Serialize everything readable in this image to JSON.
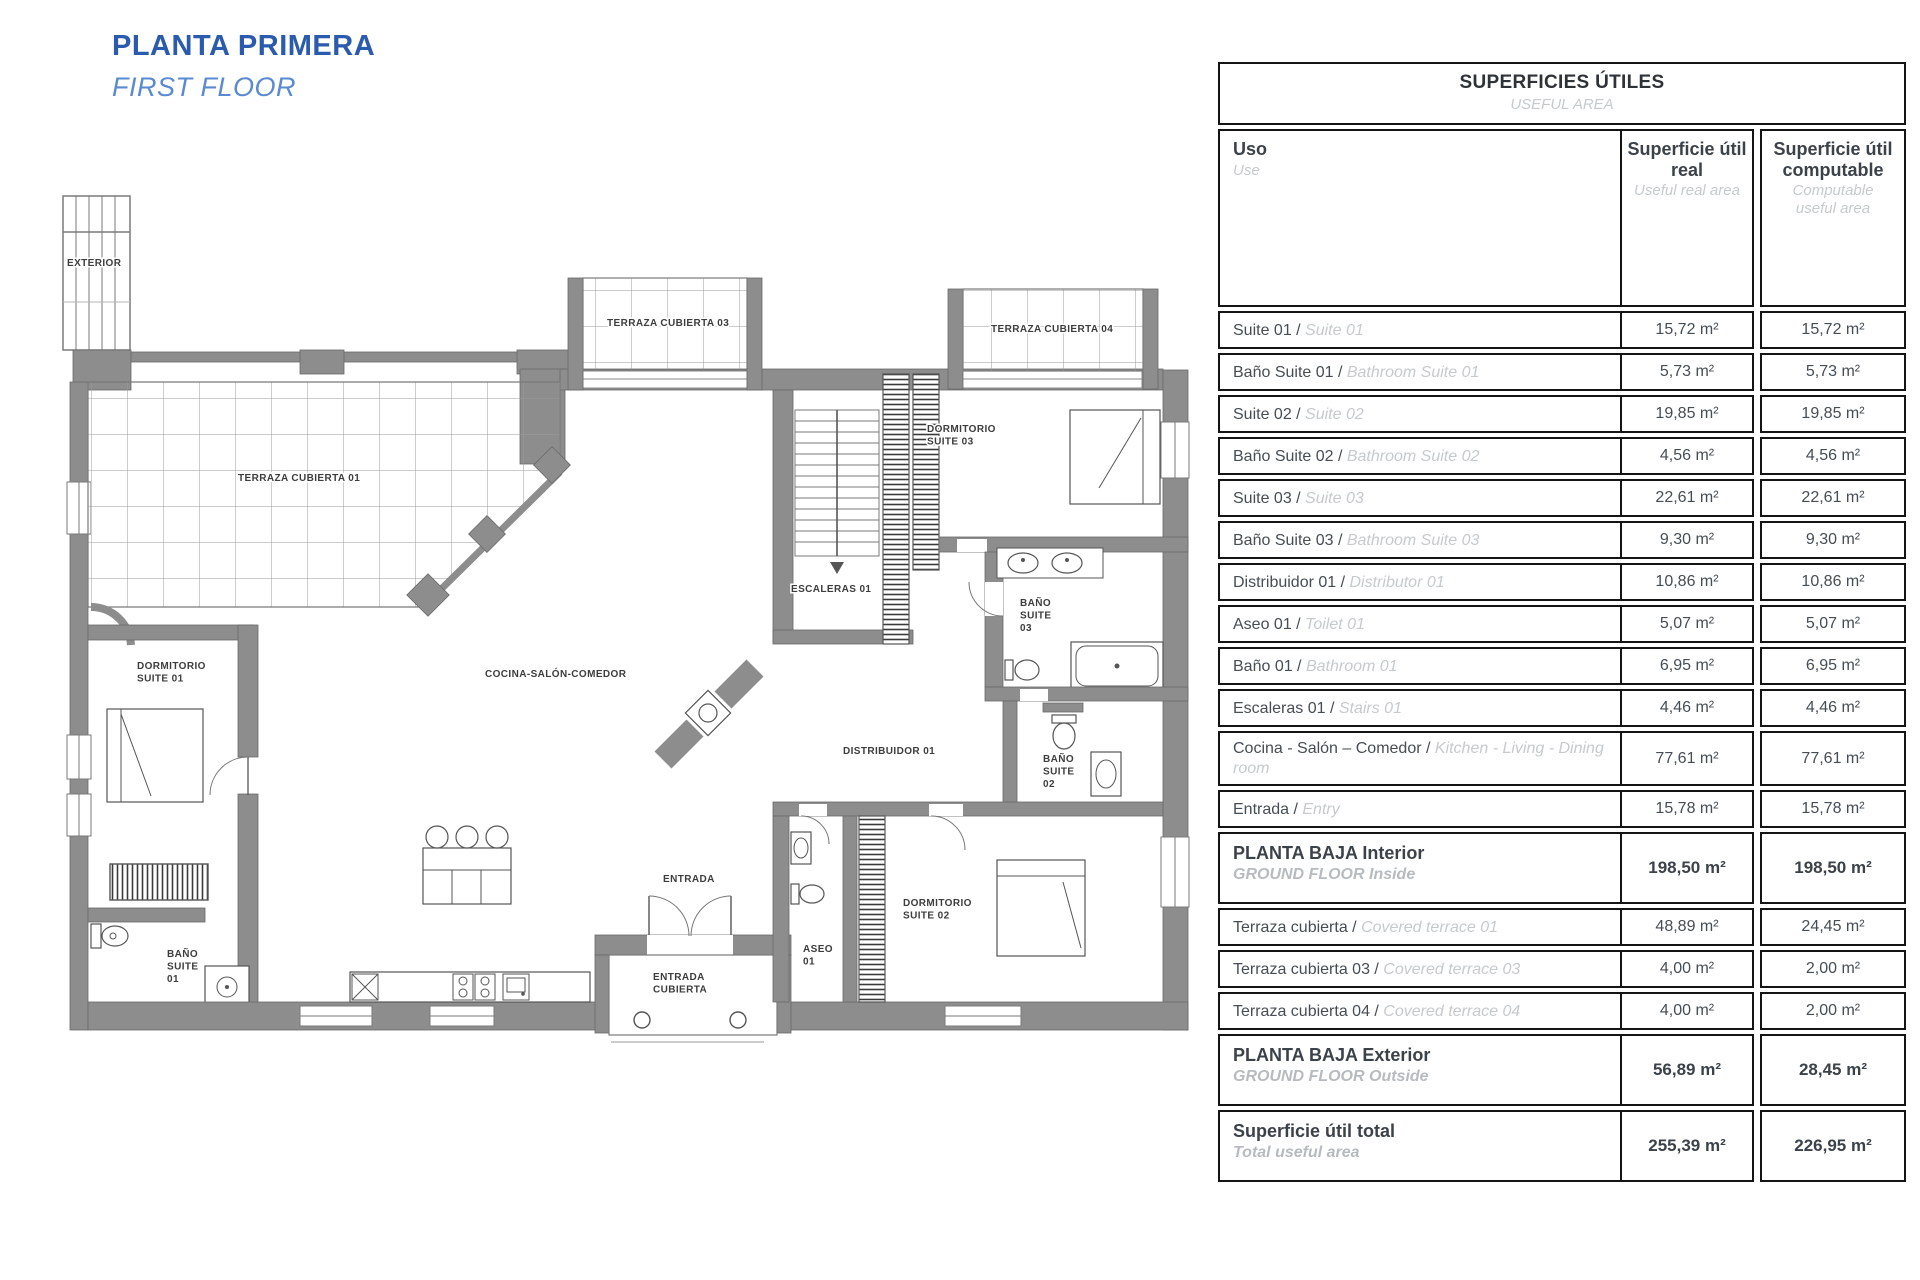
{
  "page": {
    "title_es": "PLANTA PRIMERA",
    "title_en": "FIRST FLOOR"
  },
  "colors": {
    "title_blue": "#2b5bad",
    "subtitle_blue": "#5a8ad0",
    "wall_gray": "#8d8d8d",
    "table_border": "#141414",
    "text_dark": "#474d55",
    "text_light": "#c6cacd"
  },
  "plan": {
    "labels": [
      {
        "id": "exterior",
        "text": "EXTERIOR"
      },
      {
        "id": "terraza01",
        "text": "TERRAZA CUBIERTA 01"
      },
      {
        "id": "terraza03",
        "text": "TERRAZA CUBIERTA 03"
      },
      {
        "id": "terraza04",
        "text": "TERRAZA CUBIERTA 04"
      },
      {
        "id": "dormitorio03",
        "text": "DORMITORIO\nSUITE 03"
      },
      {
        "id": "escaleras01",
        "text": "ESCALERAS 01"
      },
      {
        "id": "bano_suite03",
        "text": "BAÑO\nSUITE\n03"
      },
      {
        "id": "distribuidor01",
        "text": "DISTRIBUIDOR 01"
      },
      {
        "id": "bano_suite02",
        "text": "BAÑO\nSUITE\n02"
      },
      {
        "id": "dormitorio02",
        "text": "DORMITORIO\nSUITE 02"
      },
      {
        "id": "aseo01",
        "text": "ASEO\n01"
      },
      {
        "id": "entrada",
        "text": "ENTRADA"
      },
      {
        "id": "entrada_cubierta",
        "text": "ENTRADA\nCUBIERTA"
      },
      {
        "id": "dormitorio01",
        "text": "DORMITORIO\nSUITE 01"
      },
      {
        "id": "bano_suite01",
        "text": "BAÑO\nSUITE\n01"
      },
      {
        "id": "cocina",
        "text": "COCINA-SALÓN-COMEDOR"
      }
    ]
  },
  "table": {
    "title": "SUPERFICIES ÚTILES",
    "subtitle": "USEFUL AREA",
    "columns": {
      "uso_es": "Uso",
      "uso_en": "Use",
      "real_es": "Superficie útil real",
      "real_en": "Useful real area",
      "comp_es": "Superficie útil computable",
      "comp_en": "Computable useful area"
    },
    "rows": [
      {
        "type": "normal",
        "es": "Suite 01",
        "en": "Suite 01",
        "real": "15,72 m²",
        "comp": "15,72 m²"
      },
      {
        "type": "normal",
        "es": "Baño Suite 01",
        "en": "Bathroom Suite 01",
        "real": "5,73 m²",
        "comp": "5,73 m²"
      },
      {
        "type": "normal",
        "es": "Suite 02",
        "en": "Suite 02",
        "real": "19,85 m²",
        "comp": "19,85 m²"
      },
      {
        "type": "normal",
        "es": "Baño Suite 02",
        "en": "Bathroom Suite 02",
        "real": "4,56 m²",
        "comp": "4,56 m²"
      },
      {
        "type": "normal",
        "es": "Suite 03",
        "en": "Suite 03",
        "real": "22,61 m²",
        "comp": "22,61 m²"
      },
      {
        "type": "normal",
        "es": "Baño Suite 03",
        "en": "Bathroom Suite 03",
        "real": "9,30 m²",
        "comp": "9,30 m²"
      },
      {
        "type": "normal",
        "es": "Distribuidor 01",
        "en": "Distributor 01",
        "real": "10,86 m²",
        "comp": "10,86 m²"
      },
      {
        "type": "normal",
        "es": "Aseo 01",
        "en": "Toilet 01",
        "real": "5,07 m²",
        "comp": "5,07 m²"
      },
      {
        "type": "normal",
        "es": "Baño 01",
        "en": "Bathroom 01",
        "real": "6,95 m²",
        "comp": "6,95 m²"
      },
      {
        "type": "normal",
        "es": "Escaleras 01",
        "en": "Stairs 01",
        "real": "4,46 m²",
        "comp": "4,46 m²"
      },
      {
        "type": "normal",
        "es": "Cocina - Salón – Comedor",
        "en": "Kitchen - Living - Dining room",
        "real": "77,61 m²",
        "comp": "77,61 m²"
      },
      {
        "type": "normal",
        "es": "Entrada",
        "en": "Entry",
        "real": "15,78 m²",
        "comp": "15,78 m²"
      },
      {
        "type": "section",
        "es": "PLANTA BAJA Interior",
        "en": "GROUND FLOOR Inside",
        "real": "198,50 m²",
        "comp": "198,50 m²"
      },
      {
        "type": "normal",
        "es": "Terraza cubierta",
        "en": "Covered terrace 01",
        "real": "48,89 m²",
        "comp": "24,45 m²"
      },
      {
        "type": "normal",
        "es": "Terraza cubierta 03",
        "en": "Covered terrace 03",
        "real": "4,00 m²",
        "comp": "2,00 m²"
      },
      {
        "type": "normal",
        "es": "Terraza cubierta 04",
        "en": "Covered terrace 04",
        "real": "4,00 m²",
        "comp": "2,00 m²"
      },
      {
        "type": "section",
        "es": "PLANTA BAJA Exterior",
        "en": "GROUND FLOOR Outside",
        "real": "56,89 m²",
        "comp": "28,45 m²"
      },
      {
        "type": "section",
        "es": "Superficie útil total",
        "en": "Total useful area",
        "real": "255,39 m²",
        "comp": "226,95 m²"
      }
    ]
  }
}
